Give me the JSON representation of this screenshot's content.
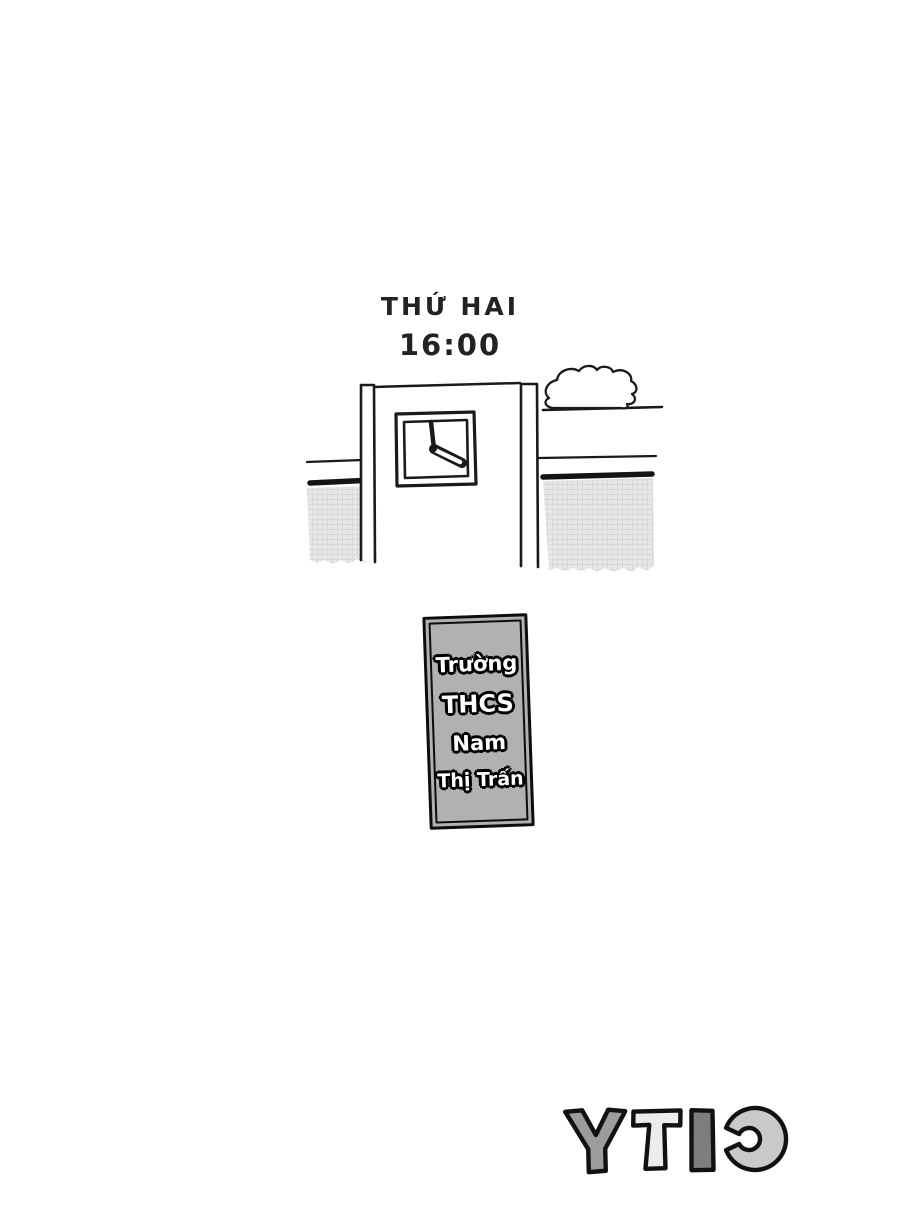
{
  "page": {
    "background": "#ffffff",
    "description": "Manga page: school gate with clock at 16:00 on Monday"
  },
  "header": {
    "day_label": "THỨ HAI",
    "time_label": "16:00"
  },
  "illustration": {
    "type": "school-gate-with-wall-clock-and-cloud",
    "clock_time_shown": "16:00",
    "colors": {
      "wall_gray": "#e7e7e7",
      "wall_grid": "#d9d9d9",
      "line_black": "#1a1a1a"
    }
  },
  "sign": {
    "lines": [
      "Trường",
      "THCS",
      "Nam",
      "Thị Trấn"
    ],
    "full_text": "Trường THCS Nam Thị Trấn",
    "background": "#b1b1b1",
    "text_color": "#ffffff",
    "outline_color": "#000000"
  },
  "logo": {
    "text": "CITY",
    "mirrored": true,
    "display_order": [
      "Y",
      "T",
      "I",
      "C"
    ],
    "letter_colors": {
      "Y": "#9c9c9c",
      "T": "#ececec",
      "I": "#7d7d7d",
      "C": "#c9c9c9"
    },
    "outline_color": "#111111"
  }
}
